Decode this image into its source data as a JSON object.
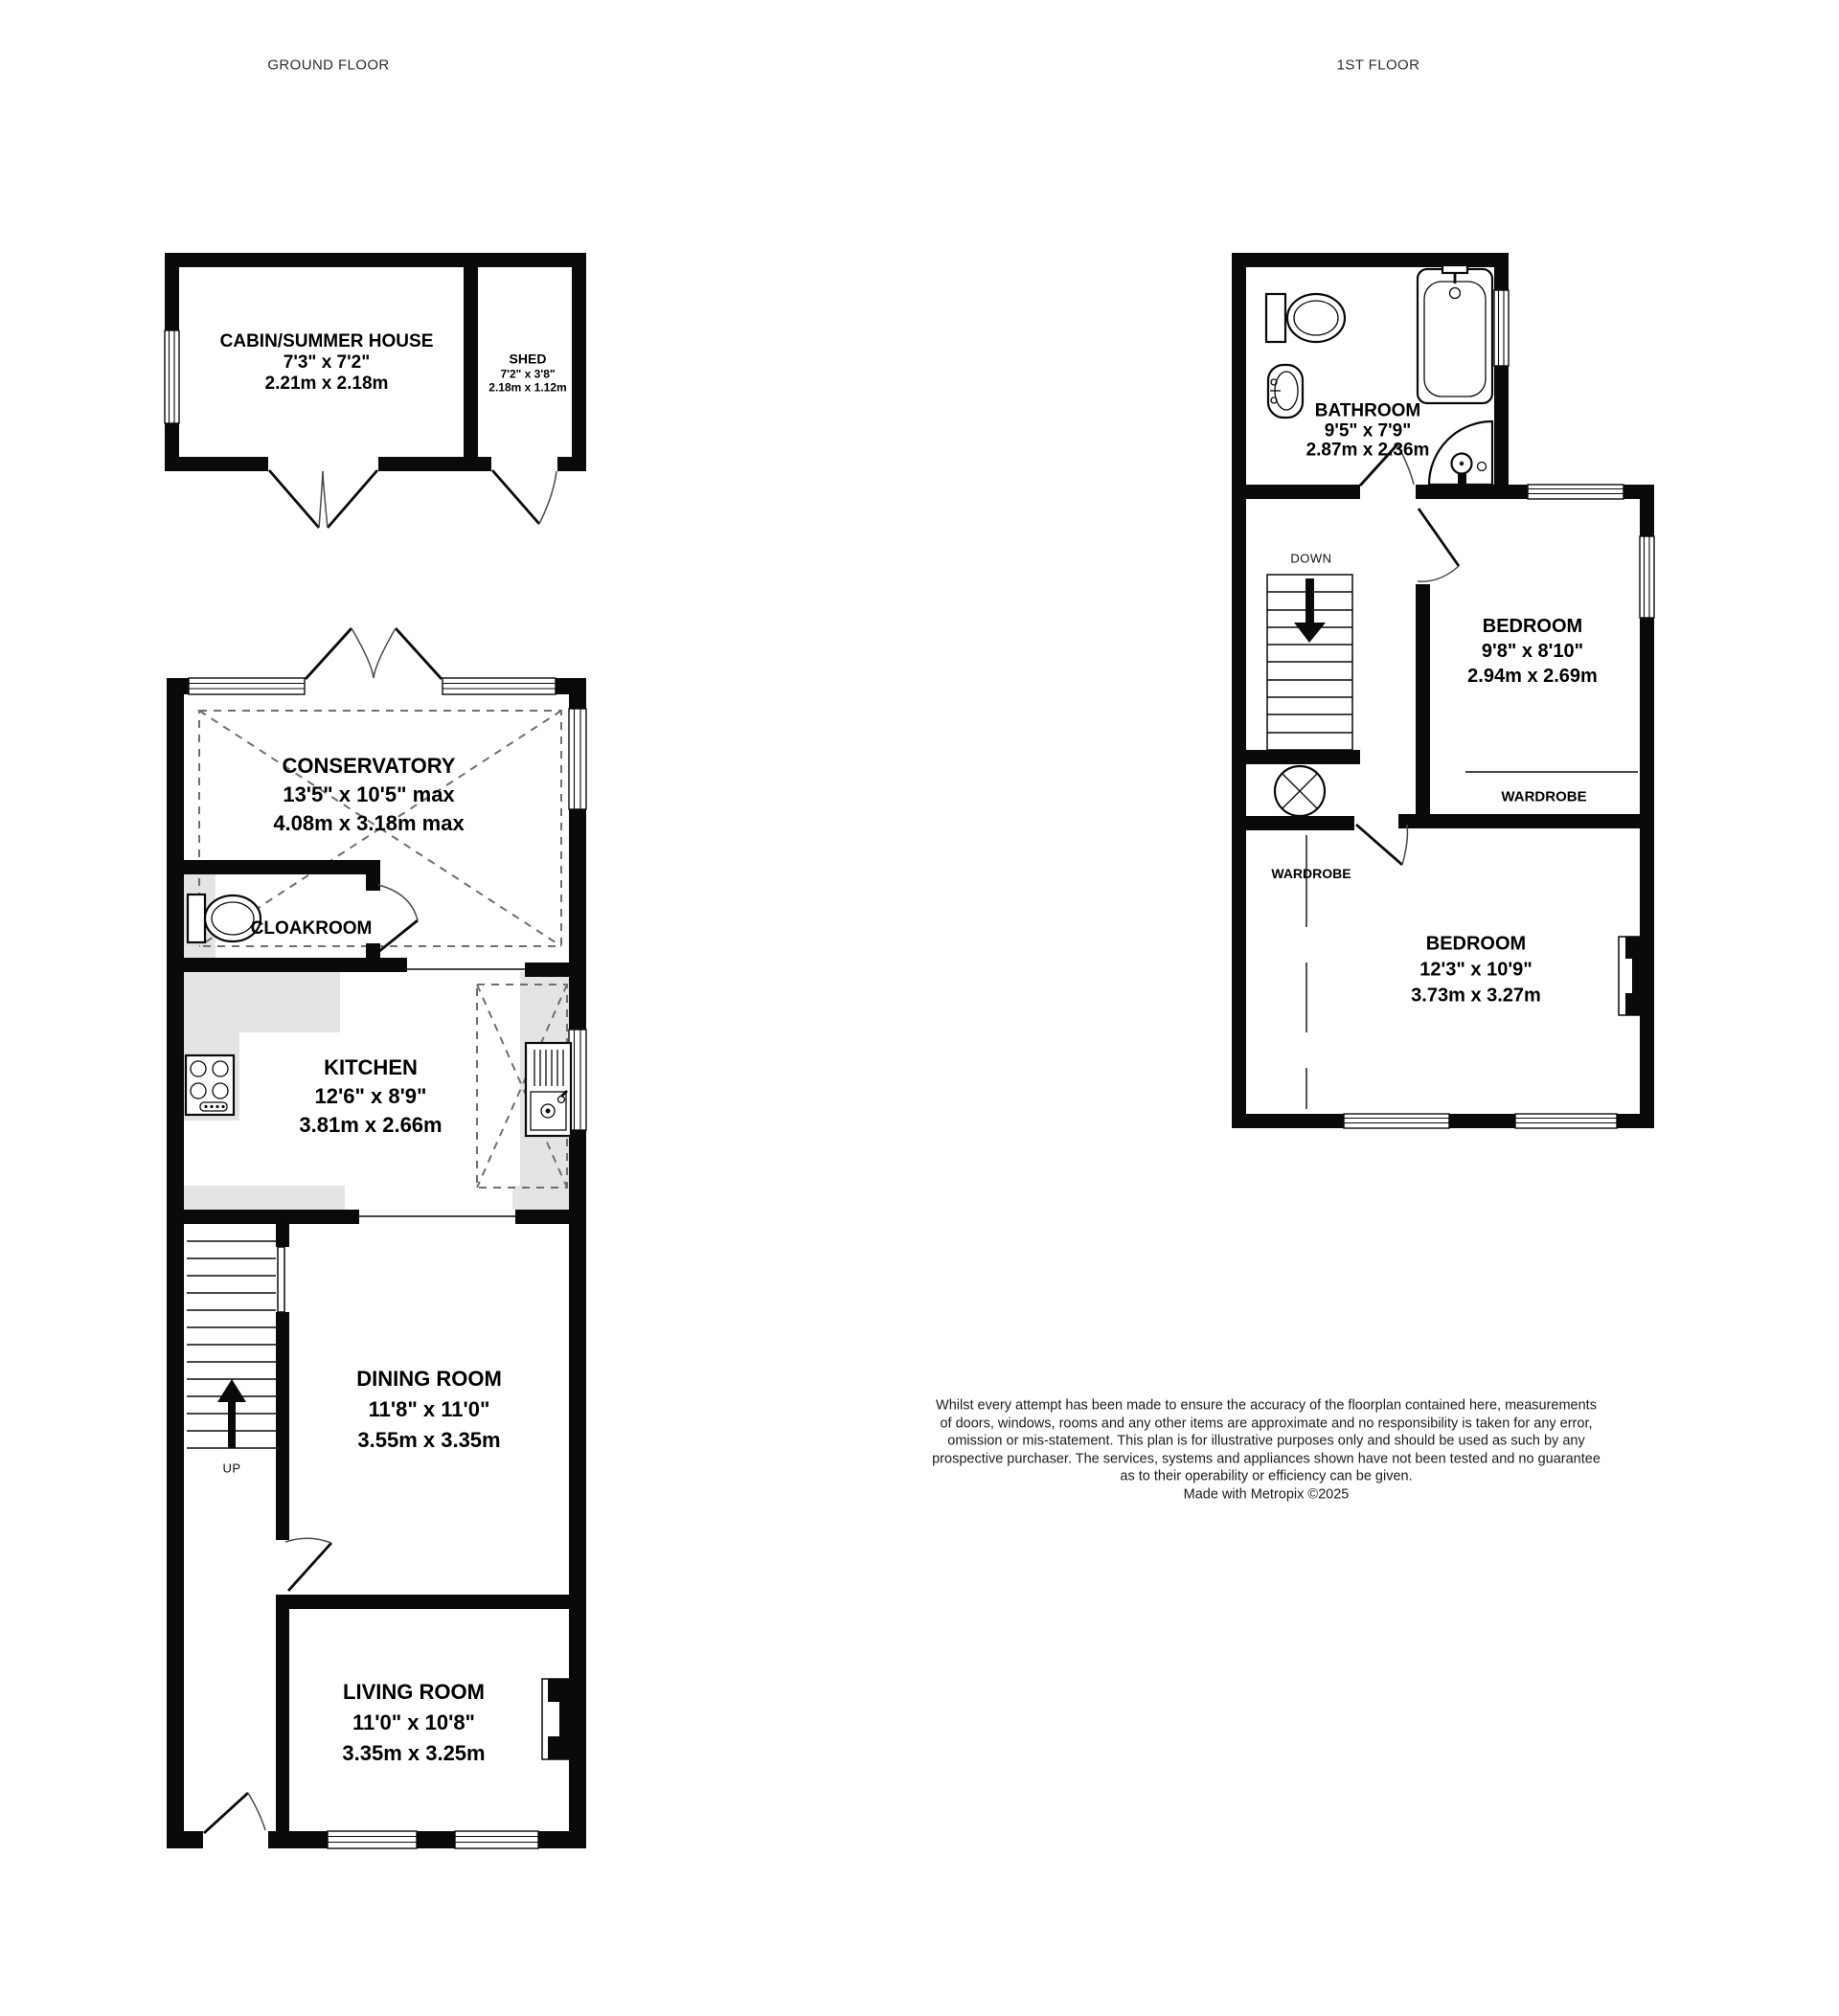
{
  "ground": {
    "title": "GROUND FLOOR",
    "rooms": {
      "cabin": {
        "name": "CABIN/SUMMER HOUSE",
        "imperial": "7'3\" x 7'2\"",
        "metric": "2.21m x 2.18m"
      },
      "shed": {
        "name": "SHED",
        "imperial": "7'2\" x 3'8\"",
        "metric": "2.18m x 1.12m"
      },
      "conservatory": {
        "name": "CONSERVATORY",
        "imperial": "13'5\" x 10'5\" max",
        "metric": "4.08m x 3.18m max"
      },
      "cloakroom": {
        "name": "CLOAKROOM"
      },
      "kitchen": {
        "name": "KITCHEN",
        "imperial": "12'6\" x 8'9\"",
        "metric": "3.81m x 2.66m"
      },
      "dining_room": {
        "name": "DINING ROOM",
        "imperial": "11'8\" x 11'0\"",
        "metric": "3.55m x 3.35m"
      },
      "living_room": {
        "name": "LIVING ROOM",
        "imperial": "11'0\" x 10'8\"",
        "metric": "3.35m x 3.25m"
      }
    },
    "stairs_label": "UP"
  },
  "first": {
    "title": "1ST FLOOR",
    "rooms": {
      "bathroom": {
        "name": "BATHROOM",
        "imperial": "9'5\" x 7'9\"",
        "metric": "2.87m x 2.36m"
      },
      "bedroom_1": {
        "name": "BEDROOM",
        "imperial": "9'8\" x 8'10\"",
        "metric": "2.94m x 2.69m",
        "wardrobe": "WARDROBE"
      },
      "bedroom_2": {
        "name": "BEDROOM",
        "imperial": "12'3\" x 10'9\"",
        "metric": "3.73m x 3.27m",
        "wardrobe": "WARDROBE"
      }
    },
    "stairs_label": "DOWN"
  },
  "disclaimer": {
    "text": "Whilst every attempt has been made to ensure the accuracy of the floorplan contained here, measurements\nof doors, windows, rooms and any other items are approximate and no responsibility is taken for any error,\nomission or mis-statement. This plan is for illustrative purposes only and should be used as such by any\nprospective purchaser. The services, systems and appliances shown have not been tested and no guarantee\nas to their operability or efficiency can be given.\nMade with Metropix ©2025"
  },
  "icons": {
    "cloakroom_toilet": "toilet-icon",
    "bathroom_toilet": "toilet-icon",
    "bathroom_basin": "sink-icon",
    "bathroom_bath": "bathtub-icon",
    "bathroom_shower": "corner-shower-icon",
    "kitchen_hob": "hob-icon",
    "kitchen_sink": "sink-drainer-icon",
    "stairs_up": "up-arrow-icon",
    "stairs_down": "down-arrow-icon",
    "landing_symbol": "circle-cross-icon"
  },
  "colors": {
    "wall": "#0a0a0a",
    "background": "#ffffff",
    "counter": "#e4e4e4",
    "roof_dash": "#6f6f6f",
    "text": "#000000",
    "muted_text": "#2e2e2e"
  }
}
